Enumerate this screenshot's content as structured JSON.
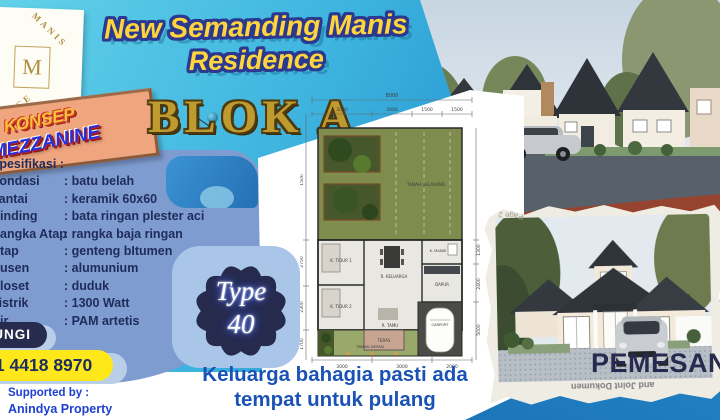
{
  "logo": {
    "top_text": "MANIS",
    "monogram": "M",
    "bottom_text": "CE"
  },
  "sign": {
    "line1": "KONSEP",
    "line2": "MEZZANINE"
  },
  "title": {
    "line1": "New Semanding Manis",
    "line2": "Residence",
    "block_label": "BLOK A"
  },
  "type_badge": {
    "line1": "Type",
    "line2": "40"
  },
  "specs": {
    "heading": "Spesifikasi :",
    "items": [
      {
        "label": "Pondasi",
        "value": "batu belah"
      },
      {
        "label": "Lantai",
        "value": "keramik 60x60"
      },
      {
        "label": "Dinding",
        "value": "bata ringan plester aci"
      },
      {
        "label": "Rangka Atap",
        "value": "rangka baja ringan"
      },
      {
        "label": "Atap",
        "value": "genteng bItumen"
      },
      {
        "label": "Kusen",
        "value": "alumunium"
      },
      {
        "label": "Closet",
        "value": "duduk"
      },
      {
        "label": "Listrik",
        "value": "1300 Watt"
      },
      {
        "label": "Air",
        "value": "PAM artetis"
      }
    ]
  },
  "contact": {
    "label": "HUBUNGI",
    "phone": "0821 4418 8970",
    "supported_by": "Supported by :",
    "agency": "Anindya Property"
  },
  "floorplan": {
    "dim_total_top": "8000",
    "dims_top": [
      "3000",
      "2000",
      "1500",
      "1500"
    ],
    "dims_bottom": [
      "3000",
      "3000",
      "2000"
    ],
    "dims_left": [
      "1500",
      "2750",
      "2300",
      "1700"
    ],
    "dims_right": [
      "1300",
      "2400",
      "5000"
    ],
    "dim_small": "1500",
    "rooms": {
      "back_yard": "TANAH BELAKANG",
      "bed1": "K. TIDUR 1",
      "bed2": "K. TIDUR 2",
      "family": "R. KELUARGA",
      "guest": "R. TAMU",
      "bath": "K. MANDI",
      "kitchen": "DAPUR",
      "terrace": "TERAS",
      "front_yard": "TAMAN DEPAN",
      "carport": "CARPORT"
    }
  },
  "photo_frame": {
    "page_label": "Page 2",
    "back_text": "and Joint Dokumen",
    "caption": "PEMESANAN"
  },
  "tagline": {
    "line1": "Keluarga bahagia pasti ada",
    "line2": "tempat untuk pulang"
  },
  "colors": {
    "accent_yellow": "#ffd43d",
    "outline_blue": "#2b3990",
    "gold": "#bf9a2e",
    "panel_blue": "#7e9cd0",
    "navy": "#272c4e",
    "phone_yellow": "#ffe81a",
    "link_blue": "#1d40cf",
    "tagline_blue": "#1a53b5",
    "triangle_blue": "#1b7cc9"
  }
}
